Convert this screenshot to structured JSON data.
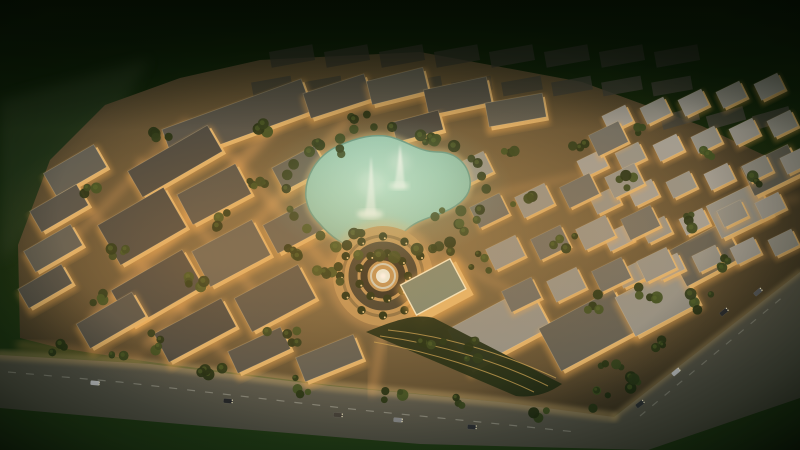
{
  "scene": {
    "type": "aerial-night-render-master-planned-community",
    "canvas": {
      "width": 800,
      "height": 450
    },
    "colors": {
      "bg_top": "#0a1a05",
      "bg_mid": "#14290c",
      "bg_bottom": "#234018",
      "asphalt": "#57564b",
      "sidewalk": "#b79b63",
      "site_center": "#8a744c",
      "site_mid": "#5c4c30",
      "site_edge": "#352e1f",
      "facade": "#e2b269",
      "facade_glow": "#f0a94f",
      "roofs": [
        "#45443e",
        "#514f47",
        "#5d5b51",
        "#908e85",
        "#9d9a92",
        "#6a6961"
      ],
      "water_center": "#bce2d1",
      "water_edge": "#7db39f",
      "water_outline": "#5f9483",
      "promenade": "#d9b97b",
      "tree_palette": [
        "#1f2c12",
        "#273617",
        "#2f401b",
        "#233113",
        "#3a4c20"
      ],
      "tree_highlight": "#4d6228",
      "palm_dark": "#1c2a11",
      "light_warm": "#ffd998",
      "glow_street": "#ffb264",
      "plume_white": "#f2faf3",
      "gold_roof": "#7b8671",
      "terrace_green": "#1c2913",
      "terrace_gold": "#caa253",
      "ghost_roof_a": "#30302a",
      "ghost_roof_b": "#3a3a32"
    },
    "outside": {
      "shore_path": "M0,100 L150,58 L104,140 L12,252 L0,262 Z"
    },
    "site": {
      "path": "M20,338 L18,245 L50,160 L105,105 L180,78 L260,60 L420,52 L582,82 L702,126 L800,172 L800,278 L612,418 L500,402 L330,385 L150,362 L60,348 Z"
    },
    "roads": {
      "asphalt_path": "M0,355 L150,364 L330,386 L500,402 L614,417 L800,272 L800,398 L648,450 L420,444 L180,424 L0,408 Z",
      "median_points": "8,372 120,382 240,396 360,410 480,422 576,432",
      "right_median_points": "640,416 676,386 712,356 748,326 784,296",
      "sidewalk_points": "0,355 150,364 330,386 500,402 614,417",
      "right_inner_points": "614,417 800,272"
    },
    "lagoon": {
      "path": "M306,198 C304,178 316,156 338,146 C356,138 376,132 394,138 C410,143 420,152 438,152 C456,152 468,164 470,180 C472,196 458,206 444,212 C430,218 416,220 404,232 C392,244 378,254 360,250 C344,246 330,236 320,224 C310,214 308,208 306,198 Z",
      "fountains": [
        {
          "plume_path": "M365,215 Q369,186 371,156 Q374,186 376,215 Z",
          "splash": [
            370,
            214,
            13,
            5
          ],
          "mist": [
            371,
            184,
            13
          ]
        },
        {
          "plume_path": "M394,188 Q398,166 400,144 Q403,166 405,188 Z",
          "splash": [
            399,
            186,
            10,
            4
          ],
          "mist": [
            400,
            162,
            10
          ]
        }
      ]
    },
    "roundabout": {
      "cx": 383,
      "cy": 276,
      "plaza_r": 50,
      "plaza_fill": "#bd9257",
      "rings": [
        [
          40,
          "#8a6f44",
          3,
          1
        ],
        [
          30,
          "#403d2f",
          9,
          1
        ],
        [
          19,
          "#2c2a20",
          7,
          1
        ],
        [
          12,
          "#cfd8cf",
          2,
          0.85
        ]
      ],
      "center_r": 7,
      "palm_rings": [
        [
          43,
          12
        ],
        [
          25,
          9
        ]
      ]
    },
    "landmarks": {
      "gold_building": {
        "cx": 436,
        "cy": 290,
        "w": 58,
        "h": 38,
        "rot": -28
      },
      "terrace_path": "M366,332 C400,318 418,314 434,318 L562,384 C548,394 532,398 516,396 Z",
      "terrace_lines": [
        "M380,336 C440,344 500,362 548,386",
        "M374,342 C430,352 488,370 534,392",
        "M388,330 C446,336 504,354 556,378"
      ]
    },
    "buildings": {
      "blocks": [
        [
          238,
          122,
          148,
          34,
          -20,
          1,
          1
        ],
        [
          176,
          163,
          92,
          30,
          -30,
          0,
          1
        ],
        [
          76,
          172,
          58,
          26,
          -30,
          2,
          1
        ],
        [
          60,
          210,
          54,
          24,
          -30,
          1,
          1
        ],
        [
          54,
          250,
          54,
          24,
          -30,
          2,
          1
        ],
        [
          46,
          288,
          50,
          22,
          -30,
          1,
          1
        ],
        [
          143,
          228,
          76,
          46,
          -30,
          0,
          1
        ],
        [
          215,
          196,
          66,
          34,
          -28,
          1,
          1
        ],
        [
          158,
          290,
          82,
          42,
          -30,
          0,
          1
        ],
        [
          232,
          255,
          68,
          40,
          -28,
          2,
          1
        ],
        [
          112,
          322,
          64,
          28,
          -30,
          1,
          1
        ],
        [
          196,
          332,
          76,
          32,
          -28,
          0,
          1
        ],
        [
          276,
          300,
          72,
          38,
          -28,
          1,
          1
        ],
        [
          296,
          228,
          56,
          32,
          -28,
          2,
          1
        ],
        [
          260,
          352,
          58,
          24,
          -25,
          1,
          1
        ],
        [
          330,
          360,
          62,
          26,
          -22,
          2,
          1
        ],
        [
          300,
          170,
          48,
          26,
          -28,
          2,
          1
        ],
        [
          338,
          98,
          64,
          26,
          -18,
          1,
          1
        ],
        [
          398,
          88,
          58,
          24,
          -14,
          2,
          1
        ],
        [
          458,
          98,
          64,
          26,
          -12,
          1,
          1
        ],
        [
          516,
          112,
          58,
          24,
          -10,
          2,
          1
        ],
        [
          418,
          128,
          48,
          20,
          -15,
          0,
          1
        ],
        [
          500,
          330,
          92,
          46,
          -28,
          3,
          1
        ],
        [
          588,
          332,
          84,
          48,
          -28,
          2,
          1
        ],
        [
          658,
          302,
          72,
          44,
          -28,
          3,
          1
        ],
        [
          706,
          256,
          62,
          40,
          -28,
          2,
          1
        ],
        [
          740,
          212,
          56,
          36,
          -26,
          3,
          1
        ],
        [
          772,
          172,
          52,
          32,
          -26,
          2,
          1
        ]
      ]
    },
    "villa_grids": [
      {
        "origin": [
          580,
          128
        ],
        "cols": 6,
        "rows": 5,
        "u": [
          38,
          -8
        ],
        "v": [
          13,
          37
        ],
        "w": 26,
        "h": 18,
        "rot": -26,
        "shade_pair": [
          3,
          4
        ],
        "skip": 0.08
      },
      {
        "origin": [
          474,
          170
        ],
        "cols": 4,
        "rows": 4,
        "u": [
          45,
          -10
        ],
        "v": [
          16,
          42
        ],
        "w": 33,
        "h": 23,
        "rot": -26,
        "shade_pair": [
          3,
          5
        ],
        "skip": 0.05
      }
    ],
    "ghost_rows": [
      {
        "y": 56,
        "x0": 292,
        "step": 55,
        "n": 8,
        "w": 44,
        "h": 16,
        "rot": -10,
        "fill": "#30302a",
        "opacity": 0.75
      },
      {
        "y": 86,
        "x0": 272,
        "step": 50,
        "n": 9,
        "w": 40,
        "h": 14,
        "rot": -10,
        "fill": "#3a3a32",
        "opacity": 0.8
      },
      {
        "y": 118,
        "x0": 680,
        "step": 46,
        "n": 3,
        "w": 38,
        "h": 14,
        "rot": -16,
        "fill": "#3e3e36",
        "opacity": 0.85
      }
    ],
    "street_glow": [
      [
        95,
        318,
        302,
        96,
        12,
        0.35
      ],
      [
        148,
        344,
        346,
        122,
        9,
        0.3
      ],
      [
        60,
        252,
        186,
        122,
        8,
        0.25
      ],
      [
        210,
        132,
        332,
        272,
        9,
        0.3
      ],
      [
        140,
        162,
        282,
        322,
        8,
        0.28
      ],
      [
        82,
        202,
        232,
        362,
        8,
        0.25
      ],
      [
        470,
        200,
        700,
        148,
        7,
        0.2
      ],
      [
        560,
        252,
        798,
        198,
        7,
        0.2
      ],
      [
        540,
        302,
        798,
        248,
        7,
        0.18
      ],
      [
        383,
        330,
        372,
        392,
        10,
        0.3
      ],
      [
        330,
        280,
        258,
        304,
        8,
        0.22
      ],
      [
        436,
        252,
        520,
        296,
        8,
        0.2
      ],
      [
        20,
        345,
        140,
        358,
        8,
        0.3
      ]
    ],
    "trees": {
      "lagoon_ring": {
        "cx": 386,
        "cy": 192,
        "rx": 100,
        "ry": 64,
        "count": 30,
        "jitter": 9
      },
      "clusters": [
        [
          250,
          182,
          5,
          16
        ],
        [
          205,
          278,
          5,
          18
        ],
        [
          282,
          332,
          5,
          16
        ],
        [
          152,
          342,
          4,
          14
        ],
        [
          100,
          300,
          4,
          12
        ],
        [
          230,
          222,
          4,
          14
        ],
        [
          330,
          272,
          6,
          18
        ],
        [
          120,
          252,
          4,
          12
        ],
        [
          90,
          190,
          3,
          10
        ],
        [
          160,
          130,
          4,
          14
        ],
        [
          330,
          150,
          4,
          12
        ],
        [
          448,
          216,
          5,
          14
        ],
        [
          348,
          238,
          5,
          14
        ],
        [
          432,
          142,
          4,
          12
        ],
        [
          520,
          200,
          4,
          14
        ],
        [
          562,
          242,
          4,
          14
        ],
        [
          622,
          182,
          4,
          12
        ],
        [
          682,
          222,
          4,
          12
        ],
        [
          722,
          262,
          4,
          12
        ],
        [
          652,
          292,
          5,
          14
        ],
        [
          752,
          182,
          3,
          10
        ],
        [
          592,
          302,
          4,
          12
        ],
        [
          702,
          302,
          4,
          12
        ],
        [
          482,
          262,
          4,
          12
        ],
        [
          442,
          252,
          3,
          10
        ],
        [
          512,
          152,
          3,
          10
        ],
        [
          582,
          142,
          3,
          10
        ],
        [
          642,
          132,
          3,
          10
        ],
        [
          712,
          152,
          3,
          10
        ],
        [
          60,
          348,
          3,
          10
        ],
        [
          115,
          360,
          3,
          10
        ],
        [
          212,
          375,
          4,
          12
        ],
        [
          302,
          386,
          4,
          12
        ],
        [
          392,
          398,
          4,
          12
        ],
        [
          462,
          404,
          3,
          10
        ],
        [
          542,
          412,
          3,
          10
        ],
        [
          612,
          372,
          4,
          12
        ],
        [
          662,
          342,
          4,
          12
        ],
        [
          470,
          350,
          5,
          14
        ],
        [
          432,
          338,
          4,
          12
        ],
        [
          266,
          130,
          3,
          10
        ],
        [
          360,
          120,
          3,
          10
        ],
        [
          300,
          250,
          4,
          12
        ],
        [
          600,
          400,
          4,
          14
        ],
        [
          640,
          380,
          4,
          12
        ]
      ]
    },
    "dot_clusters": [
      {
        "cx": 332,
        "cy": 228,
        "count": 26,
        "spread": 30
      },
      {
        "cx": 252,
        "cy": 296,
        "count": 18,
        "spread": 24
      },
      {
        "cx": 182,
        "cy": 250,
        "count": 14,
        "spread": 22
      },
      {
        "cx": 470,
        "cy": 345,
        "count": 14,
        "spread": 26
      },
      {
        "cx": 360,
        "cy": 378,
        "count": 16,
        "spread": 30
      }
    ],
    "street_lights": [
      [
        25,
        352
      ],
      [
        65,
        356
      ],
      [
        105,
        360
      ],
      [
        145,
        363
      ],
      [
        185,
        368
      ],
      [
        225,
        373
      ],
      [
        265,
        378
      ],
      [
        305,
        383
      ],
      [
        345,
        388
      ],
      [
        385,
        392
      ],
      [
        425,
        396
      ],
      [
        465,
        400
      ],
      [
        505,
        404
      ],
      [
        545,
        408
      ],
      [
        585,
        413
      ],
      [
        630,
        409
      ],
      [
        665,
        378
      ],
      [
        700,
        350
      ],
      [
        735,
        323
      ],
      [
        770,
        296
      ]
    ],
    "cars": [
      [
        95,
        383,
        5,
        "#d2d4d8"
      ],
      [
        228,
        401,
        5,
        "#22252a"
      ],
      [
        338,
        415,
        5,
        "#45413b"
      ],
      [
        472,
        427,
        4,
        "#2b2f36"
      ],
      [
        398,
        420,
        5,
        "#8a8d91"
      ],
      [
        640,
        404,
        -38,
        "#2e3236"
      ],
      [
        676,
        372,
        -40,
        "#c6c8cb"
      ],
      [
        724,
        312,
        -40,
        "#26292f"
      ],
      [
        758,
        292,
        -40,
        "#54585e"
      ]
    ],
    "parking": {
      "origin": [
        556,
        282
      ],
      "rows": 2,
      "cols": 8,
      "u": [
        11.5,
        3.2
      ],
      "v": [
        -7,
        13
      ],
      "w": 8,
      "h": 4.5,
      "rot": -28
    }
  }
}
